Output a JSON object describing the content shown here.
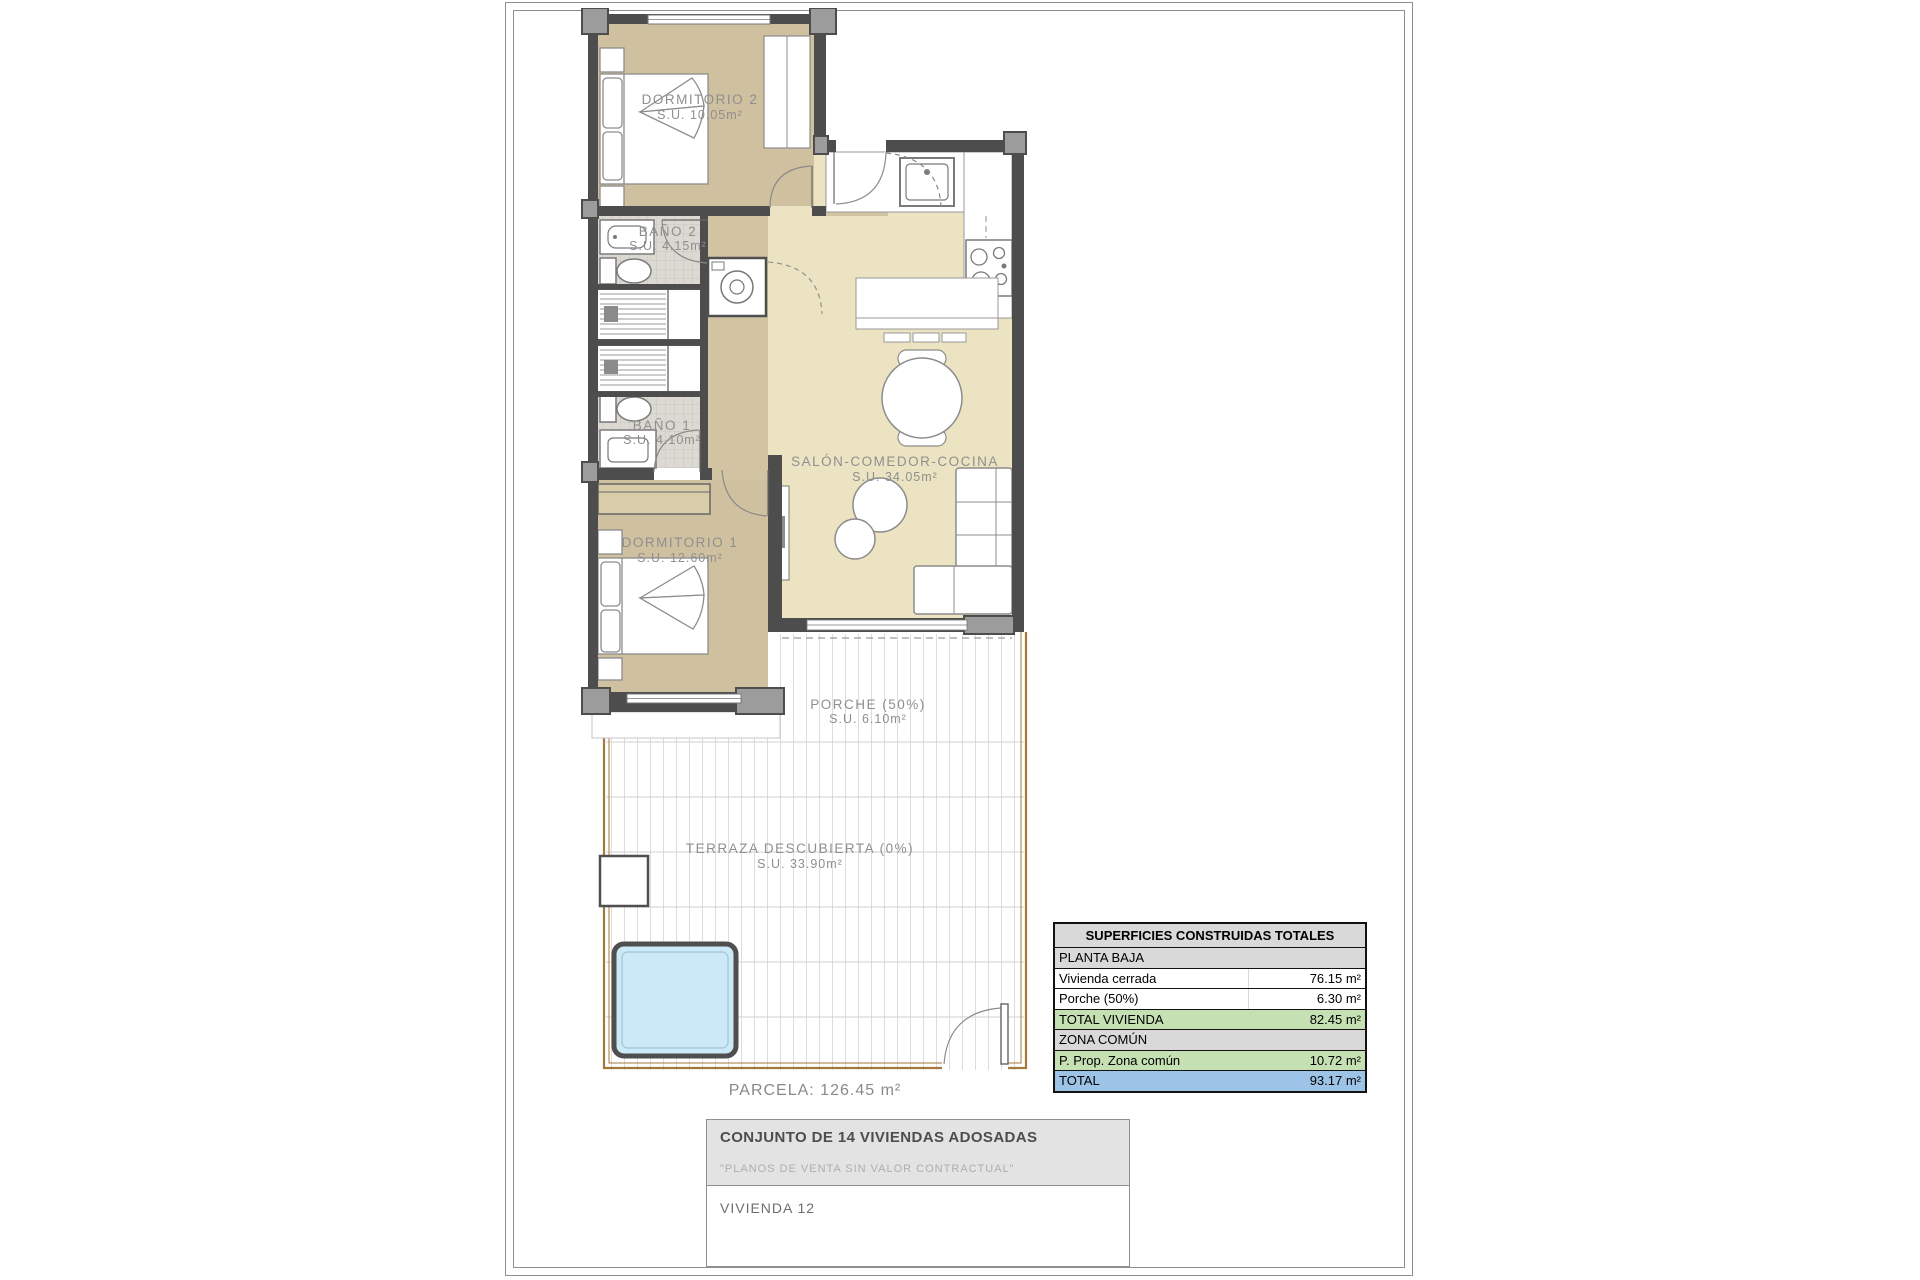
{
  "plan": {
    "parcela_label": "PARCELA: 126.45 m²",
    "rooms": [
      {
        "name": "DORMITORIO 2",
        "area": "S.U. 10.05m²"
      },
      {
        "name": "BAÑO 2",
        "area": "S.U. 4.15m²"
      },
      {
        "name": "BAÑO 1",
        "area": "S.U. 4.10m²"
      },
      {
        "name": "DORMITORIO 1",
        "area": "S.U. 12.60m²"
      },
      {
        "name": "SALÓN-COMEDOR-COCINA",
        "area": "S.U. 34.05m²"
      },
      {
        "name": "PORCHE (50%)",
        "area": "S.U. 6.10m²"
      },
      {
        "name": "TERRAZA DESCUBIERTA (0%)",
        "area": "S.U. 33.90m²"
      }
    ]
  },
  "areas_table": {
    "title": "SUPERFICIES CONSTRUIDAS TOTALES",
    "rows": [
      {
        "label": "PLANTA BAJA",
        "value": "",
        "type": "section"
      },
      {
        "label": "Vivienda cerrada",
        "value": "76.15 m²",
        "type": "normal"
      },
      {
        "label": "Porche (50%)",
        "value": "6.30 m²",
        "type": "normal"
      },
      {
        "label": "TOTAL VIVIENDA",
        "value": "82.45 m²",
        "type": "subtotal"
      },
      {
        "label": "ZONA COMÚN",
        "value": "",
        "type": "section"
      },
      {
        "label": "P. Prop. Zona común",
        "value": "10.72 m²",
        "type": "subtotal"
      },
      {
        "label": "TOTAL",
        "value": "93.17 m²",
        "type": "total"
      }
    ]
  },
  "title_block": {
    "project": "CONJUNTO DE 14 VIVIENDAS ADOSADAS",
    "disclaimer": "\"PLANOS DE VENTA SIN VALOR CONTRACTUAL\"",
    "unit": "VIVIENDA 12"
  },
  "colors": {
    "room_fill_bedroom": "#cfc1a0",
    "room_fill_living": "#ebe3c1",
    "room_fill_hall": "#d2c4a3",
    "bath_tile": "#dcd9d3",
    "wall": "#4d4d4d",
    "pier": "#9c9c9c",
    "parcel_border": "#a5783c",
    "pool_fill": "#cbe9f6",
    "label_text": "#8f8f8f",
    "table_header_bg": "#d9d9d9",
    "table_subtotal_bg": "#c5e0b3",
    "table_total_bg": "#9dc3e6"
  }
}
